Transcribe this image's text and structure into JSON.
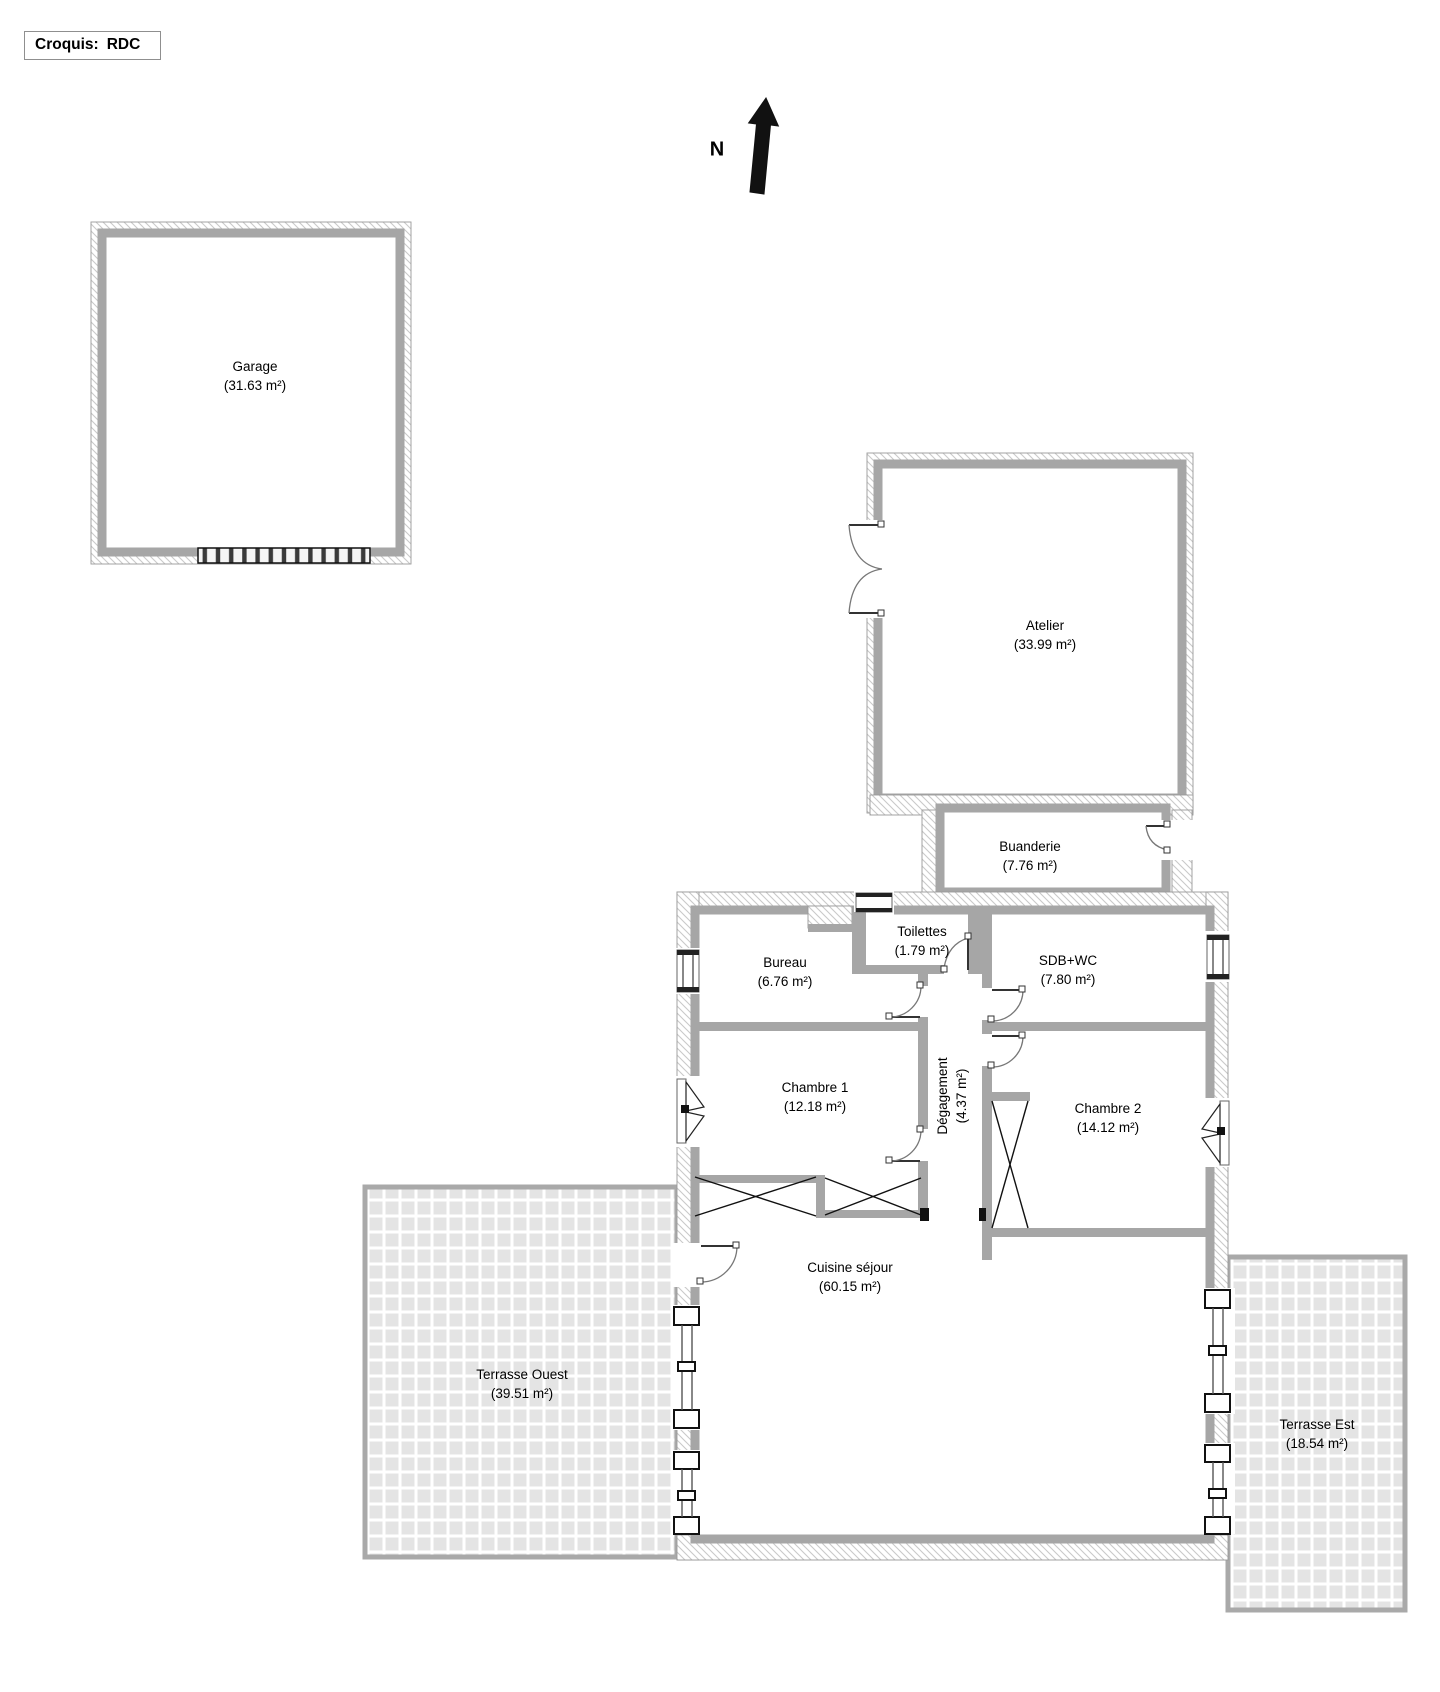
{
  "title": {
    "label": "Croquis:",
    "value": "RDC"
  },
  "compass": {
    "label": "N"
  },
  "rooms": {
    "garage": {
      "name": "Garage",
      "area": "(31.63 m²)"
    },
    "atelier": {
      "name": "Atelier",
      "area": "(33.99 m²)"
    },
    "buanderie": {
      "name": "Buanderie",
      "area": "(7.76 m²)"
    },
    "bureau": {
      "name": "Bureau",
      "area": "(6.76 m²)"
    },
    "toilettes": {
      "name": "Toilettes",
      "area": "(1.79 m²)"
    },
    "sdb": {
      "name": "SDB+WC",
      "area": "(7.80 m²)"
    },
    "chambre1": {
      "name": "Chambre 1",
      "area": "(12.18 m²)"
    },
    "degagement": {
      "name": "Dégagement",
      "area": "(4.37 m²)"
    },
    "chambre2": {
      "name": "Chambre 2",
      "area": "(14.12 m²)"
    },
    "cuisine": {
      "name": "Cuisine séjour",
      "area": "(60.15 m²)"
    },
    "terrasse_ouest": {
      "name": "Terrasse Ouest",
      "area": "(39.51 m²)"
    },
    "terrasse_est": {
      "name": "Terrasse Est",
      "area": "(18.54 m²)"
    }
  },
  "colors": {
    "wall": "#a6a6a6",
    "tile": "#e4e4e4",
    "hatch_line": "#c9c9c9",
    "text": "#000000"
  }
}
